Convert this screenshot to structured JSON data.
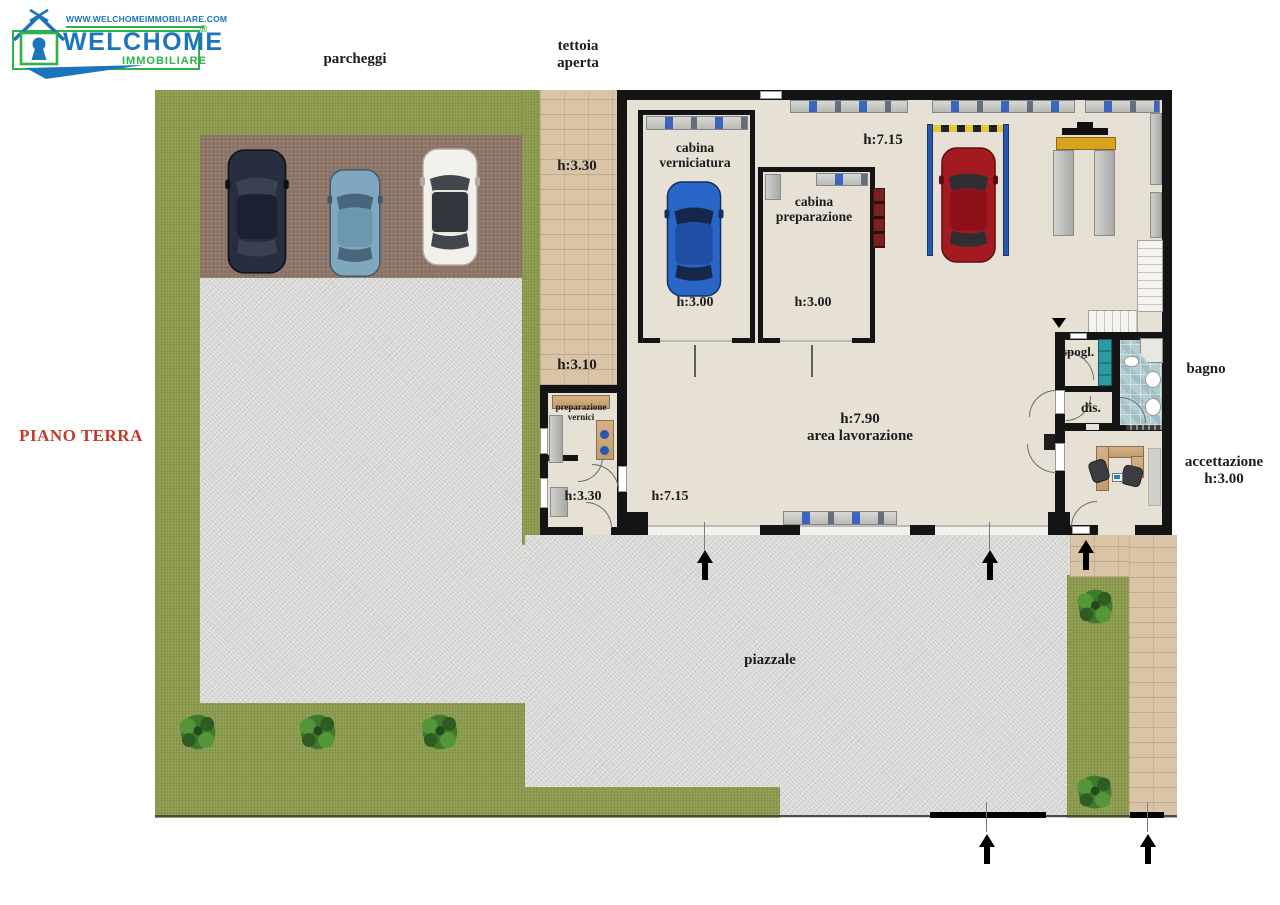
{
  "logo": {
    "website": "WWW.WELCHOMEIMMOBILIARE.COM",
    "brand": "WELCHOME",
    "registered": "®",
    "subtitle": "IMMOBILIARE"
  },
  "labels": {
    "floor": "PIANO TERRA",
    "parcheggi": "parcheggi",
    "tettoia_line1": "tettoia",
    "tettoia_line2": "aperta",
    "piazzale": "piazzale"
  },
  "heights": {
    "tettoia_top": "h:3.30",
    "tettoia_bottom": "h:3.10",
    "workshop_top": "h:7.15",
    "workshop_main": "h:7.90",
    "workshop_bottom": "h:7.15",
    "annex_room": "h:3.30",
    "cabina_verniciatura": "h:3.00",
    "cabina_preparazione": "h:3.00",
    "accettazione": "h:3.00"
  },
  "rooms": {
    "cabina_verniciatura_line1": "cabina",
    "cabina_verniciatura_line2": "verniciatura",
    "cabina_preparazione_line1": "cabina",
    "cabina_preparazione_line2": "preparazione",
    "area_lavorazione": "area lavorazione",
    "preparazione_vernici_line1": "preparazione",
    "preparazione_vernici_line2": "vernici",
    "spogliatoio": "spogl.",
    "disimpegno": "dis.",
    "bagno": "bagno",
    "accettazione": "accettazione"
  },
  "palette": {
    "grass": "#8d9b4f",
    "concrete": "#d7d7d5",
    "parking_pavement": "#8e7568",
    "paver_tan": "#d9c4a8",
    "building_floor": "#e6e1d4",
    "wall": "#141414",
    "bath_tile": "#b2cdd1",
    "floor_label_red": "#c13a2c",
    "logo_blue": "#1b75bc",
    "logo_green": "#2eb34a"
  }
}
